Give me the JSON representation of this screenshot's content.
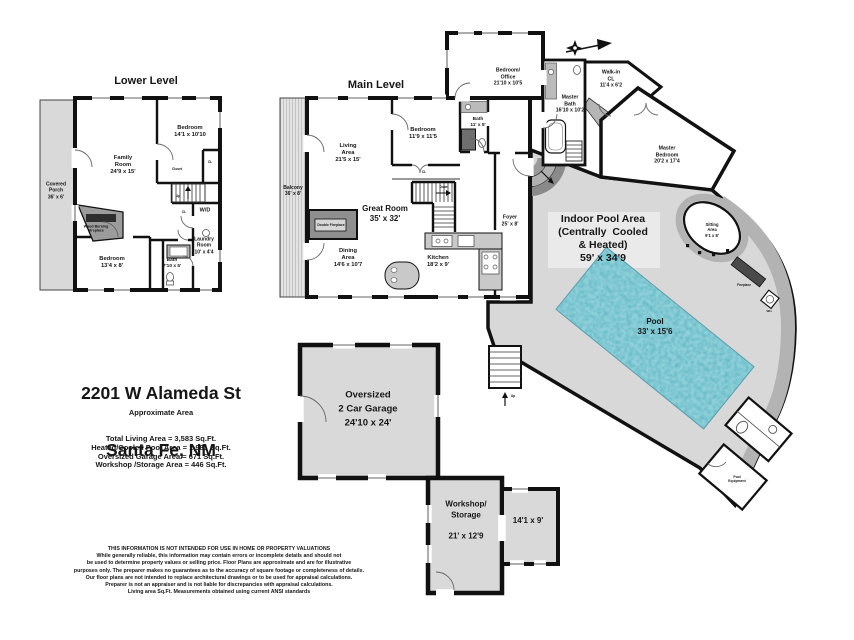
{
  "levels": {
    "lower_title": "Lower Level",
    "main_title": "Main Level"
  },
  "title_block": {
    "address_line1": "2201 W Alameda St",
    "address_line2": "Santa Fe, NM",
    "area_heading": "Approximate Area",
    "area_lines": [
      "Total Living Area = 3,583 Sq.Ft.",
      "Heated/Cooled Pool Area = 1,981 Sq.Ft.",
      "Oversized Garage Area = 671 Sq.Ft.",
      "Workshop /Storage Area = 446 Sq.Ft."
    ]
  },
  "rooms": {
    "covered_porch": "Covered\nPorch\n36' x 6'",
    "family_room": "Family\nRoom\n24'9 x 15'",
    "bedroom_ll_top": "Bedroom\n14'1 x 10'10",
    "bedroom_ll_bottom": "Bedroom\n13'4 x 8'",
    "bath_ll": "Bath\n7'10 x 5'",
    "laundry": "Laundry\nRoom\n10' x 4'4",
    "wd": "W/D",
    "wood_fireplace": "Wood Burning\nFireplace",
    "closet": "Closet",
    "up_ll": "Up",
    "cl1": "CL",
    "cl2": "CL",
    "cl3": "CL",
    "balcony": "Balcony\n36' x 8'",
    "living_area": "Living\nArea\n21'5 x 15'",
    "bedroom_ml": "Bedroom\n11'9 x 11'5",
    "bath_ml": "Bath\n11' x 5'",
    "great_room": "Great Room\n35' x 32'",
    "double_fireplace": "Double Fireplace",
    "dining_area": "Dining\nArea\n14'6 x 10'7",
    "kitchen": "Kitchen\n18'2 x 9'",
    "foyer": "Foyer\n25' x 8'",
    "bedroom_office": "Bedroom/\nOffice\n21'10 x 10'5",
    "master_bath": "Master\nBath\n16'10 x 10'2",
    "walk_in": "Walk-in\nCL\n11'4 x 6'2",
    "master_bedroom": "Master\nBedroom\n20'2 x 17'4",
    "sitting_area": "Sitting\nArea\n9'1 x 8'",
    "fireplace": "Fireplace",
    "indoor_pool": "Indoor Pool Area\n(Centrally  Cooled\n& Heated)\n59' x 34'9",
    "pool": "Pool\n33' x 15'6",
    "pool_equipment": "Pool\nEquipment",
    "wh": "WH",
    "garage": "Oversized\n2 Car Garage\n24'10 x 24'",
    "workshop": "Workshop/\nStorage\n\n21' x 12'9",
    "storage_room": "14'1 x 9'",
    "down_ml": "Down",
    "up_entry": "Up"
  },
  "disclaimer": {
    "lines": [
      "THIS INFORMATION IS NOT INTENDED FOR USE IN HOME OR PROPERTY VALUATIONS",
      "While generally reliable, this information may contain errors or incomplete details and should not",
      "be used to determine property values or selling price. Floor Plans are approximate and are for illustrative",
      "purposes only. The preparer makes no guarantees as to the accuracy of square footage or completeness of details.",
      "Our floor plans are not intended to replace architectural drawings or to be used for appraisal calculations.",
      "Preparer is not an appraiser and is not liable for discrepancies with appraisal calculations.",
      "Living area Sq.Ft. Measurements obtained using current ANSI standards"
    ]
  },
  "icons": {
    "north_arrow": "north-arrow"
  },
  "colors": {
    "wall": "#111111",
    "light_gray": "#d9d9d9",
    "deck_gray": "#b3b3b3",
    "dark_gray": "#8c8c8c",
    "pool_teal": "#56aebc"
  }
}
